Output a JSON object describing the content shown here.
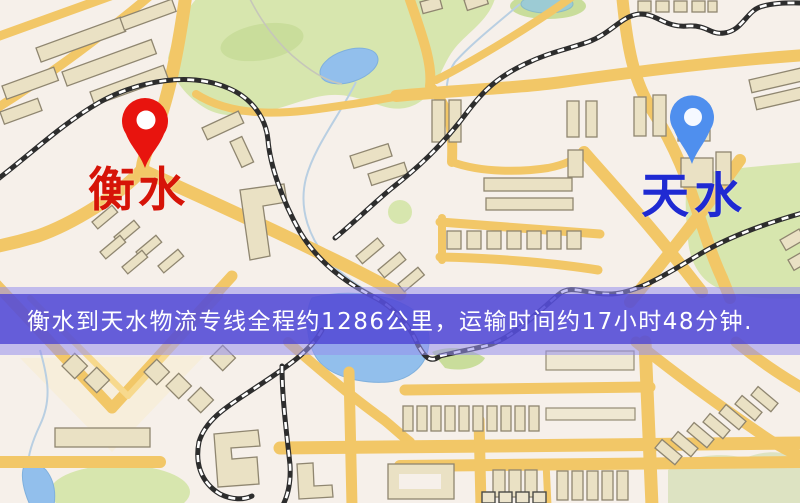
{
  "map": {
    "type": "road-map",
    "origin_marker": {
      "icon": "red-location-pin",
      "label": "衡水",
      "pin_color": "#e8140e",
      "label_color": "#d61408"
    },
    "destination_marker": {
      "icon": "blue-location-pin",
      "label": "天水",
      "pin_color": "#4f8fee",
      "label_color": "#1f2ad2"
    },
    "colors": {
      "background": "#f6f0ea",
      "road": "#f2c767",
      "road_light": "#f7d98d",
      "building_fill": "#eae1c4",
      "building_outline": "#8f8670",
      "park": "#d7e6ae",
      "water": "#92bfec",
      "railway": "#2d2d2d"
    }
  },
  "banner": {
    "text": "衡水到天水物流专线全程约1286公里，运输时间约17小时48分钟.",
    "text_color": "#ffffff",
    "inner_bg": "rgba(76,66,212,0.78)",
    "outer_bg": "rgba(150,144,236,0.55)"
  }
}
